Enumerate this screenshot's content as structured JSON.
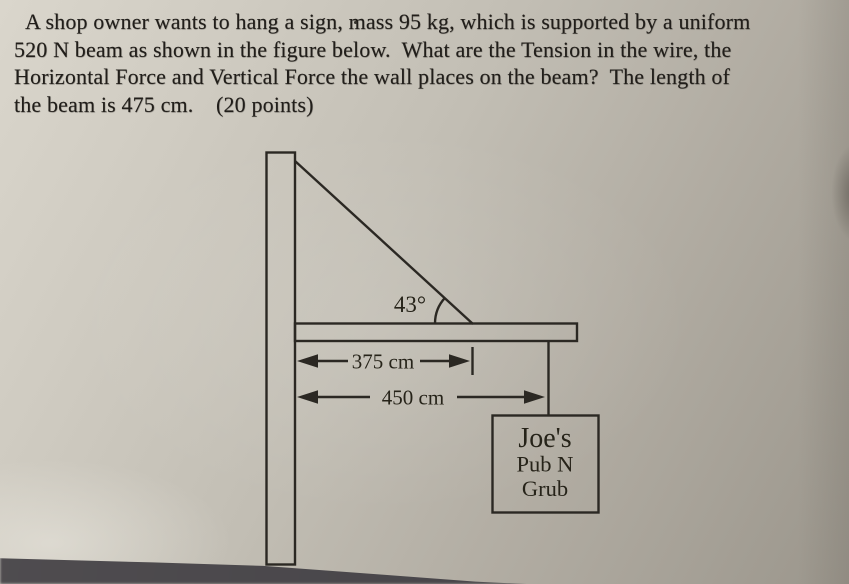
{
  "problem": {
    "lines": [
      "A shop owner wants to hang a sign, mass 95 kg, which is supported by a uniform",
      "520 N beam as shown in the figure below.  What are the Tension in the wire, the",
      "Horizontal Force and Vertical Force the wall places on the beam?  The length of",
      "the beam is 475 cm.    (20 points)"
    ]
  },
  "figure": {
    "angle_label": "43°",
    "dim_wall_to_wire": "375 cm",
    "dim_wall_to_sign": "450 cm",
    "sign_lines": [
      "Joe's",
      "Pub N",
      "Grub"
    ]
  },
  "colors": {
    "paper_light": "#dad6cc",
    "paper_dark": "#9b968c",
    "ink": "#2b2823",
    "corner_shadow": "#454349",
    "top_edge": "#141311"
  }
}
